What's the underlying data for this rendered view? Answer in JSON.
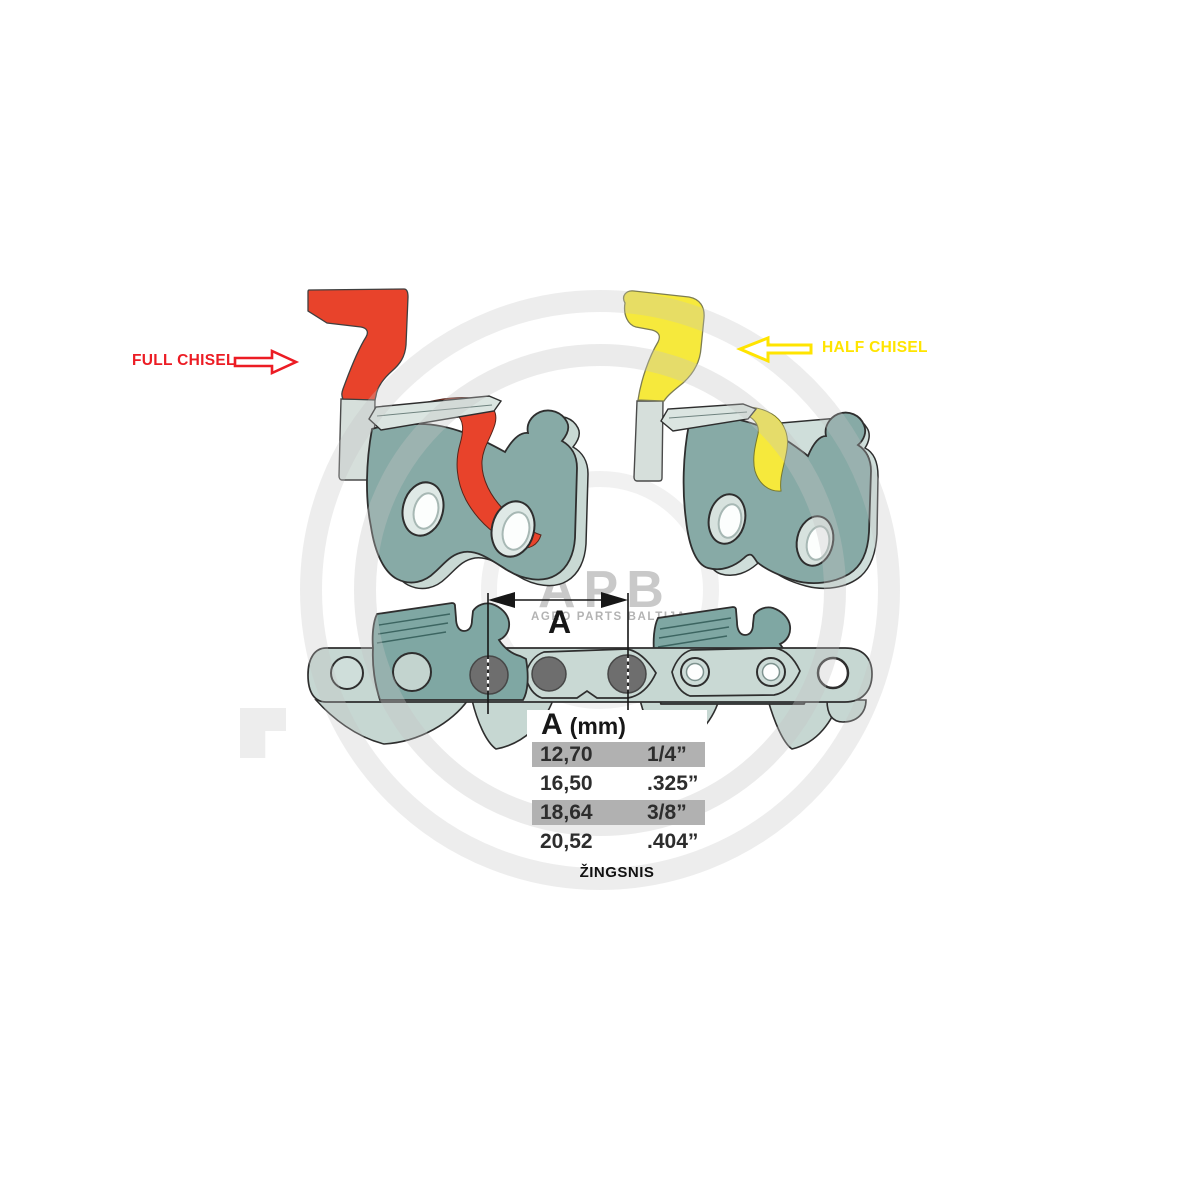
{
  "labels": {
    "full_chisel": "FULL CHISEL",
    "half_chisel": "HALF CHISEL",
    "dimension": "A",
    "pitch_caption": "ŽINGSNIS"
  },
  "pitch_table": {
    "header": {
      "symbol": "A",
      "unit": "(mm)"
    },
    "rows": [
      {
        "mm": "12,70",
        "inch": "1/4”",
        "highlighted": true
      },
      {
        "mm": "16,50",
        "inch": ".325”",
        "highlighted": false
      },
      {
        "mm": "18,64",
        "inch": "3/8”",
        "highlighted": true
      },
      {
        "mm": "20,52",
        "inch": ".404”",
        "highlighted": false
      }
    ]
  },
  "watermark": {
    "logo": "APB",
    "subtext": "AGRO PARTS BALTIJA"
  },
  "colors": {
    "full_chisel_red": "#ec1c24",
    "profile_red": "#e8432b",
    "half_chisel_yellow": "#ffe400",
    "profile_yellow": "#f6e93c",
    "link_teal": "#87aaa6",
    "link_edge_light": "#cbdbd6",
    "chain_sage": "#c6d7d2",
    "cutter_teal": "#7fa7a3",
    "rivet_gray": "#6e6e6e",
    "table_row_gray": "#b1b1b1"
  }
}
